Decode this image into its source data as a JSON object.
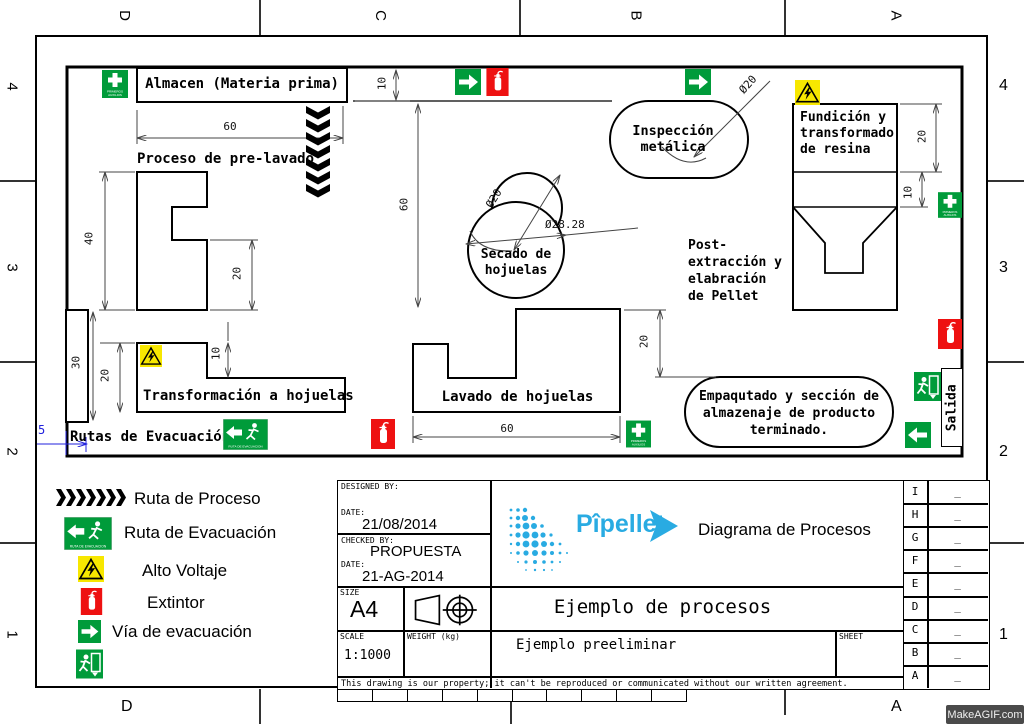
{
  "frame": {
    "top_letters": [
      "D",
      "C",
      "B",
      "A"
    ],
    "bottom_letters": [
      "D",
      "A"
    ],
    "left_numbers": [
      "4",
      "3",
      "2",
      "1"
    ],
    "right_numbers": [
      "4",
      "3",
      "2",
      "1"
    ]
  },
  "watermark": "MakeAGIF.com",
  "plan": {
    "rooms": {
      "almacen": "Almacen (Materia prima)",
      "prelavado": "Proceso de pre-lavado",
      "transformacion": "Transformación a hojuelas",
      "lavado": "Lavado de hojuelas",
      "secado_l1": "Secado de",
      "secado_l2": "hojuelas",
      "inspeccion_l1": "Inspección",
      "inspeccion_l2": "metálica",
      "fundicion_l1": "Fundición y",
      "fundicion_l2": "transformado",
      "fundicion_l3": "de resina",
      "post_l1": "Post-",
      "post_l2": "extracción y",
      "post_l3": "elabración",
      "post_l4": "de Pellet",
      "empaque_l1": "Empaqutado y sección de",
      "empaque_l2": "almazenaje de producto",
      "empaque_l3": "terminado.",
      "rutas_evacuacion": "Rutas de Evacuación",
      "salida": "Salida"
    },
    "dims": {
      "corridor_10": "10",
      "almacen_60": "60",
      "vert_60": "60",
      "prelavado_40": "40",
      "prelavado_20": "20",
      "left_30": "30",
      "transf_20": "20",
      "transf_10": "10",
      "lavado_20": "20",
      "lavado_60": "60",
      "fund_20": "20",
      "fund_10": "10",
      "insp_dia": "Ø20",
      "secado_dia": "Ø20",
      "secado_dia2": "Ø28.28",
      "blue_5": "5"
    },
    "signs": {
      "primeros_l1": "PRIMEROS",
      "primeros_l2": "AUXILIOS",
      "ruta_evac_txt": "RUTA DE EVACUACION"
    }
  },
  "legend": {
    "items": [
      {
        "label": "Ruta de Proceso"
      },
      {
        "label": "Ruta de Evacuación"
      },
      {
        "label": "Alto Voltaje"
      },
      {
        "label": "Extintor"
      },
      {
        "label": "Vía de evacuación"
      },
      {
        "label": ""
      }
    ]
  },
  "titleblock": {
    "designed_by_label": "DESIGNED BY:",
    "date_label": "DATE:",
    "date1": "21/08/2014",
    "checked_by_label": "CHECKED BY:",
    "checked_by": "PROPUESTA",
    "date2_label": "DATE:",
    "date2": "21-AG-2014",
    "size_label": "SIZE",
    "size": "A4",
    "scale_label": "SCALE",
    "scale": "1:1000",
    "weight_label": "WEIGHT (kg)",
    "sheet_label": "SHEET",
    "brand": "Pîpellet",
    "doc_type": "Diagrama de Procesos",
    "title": "Ejemplo de procesos",
    "subtitle": "Ejemplo preeliminar",
    "disclaimer": "This drawing is our property; it can't be reproduced or communicated without our written agreement."
  },
  "revisions": {
    "rows": [
      {
        "letter": "I",
        "value": "_"
      },
      {
        "letter": "H",
        "value": "_"
      },
      {
        "letter": "G",
        "value": "_"
      },
      {
        "letter": "F",
        "value": "_"
      },
      {
        "letter": "E",
        "value": "_"
      },
      {
        "letter": "D",
        "value": "_"
      },
      {
        "letter": "C",
        "value": "_"
      },
      {
        "letter": "B",
        "value": "_"
      },
      {
        "letter": "A",
        "value": "_"
      }
    ]
  },
  "colors": {
    "safety_green": "#009b3a",
    "safety_red": "#ee1111",
    "safety_yellow": "#f7e700",
    "dim_blue": "#2222dd",
    "brand_blue": "#29abe2"
  }
}
